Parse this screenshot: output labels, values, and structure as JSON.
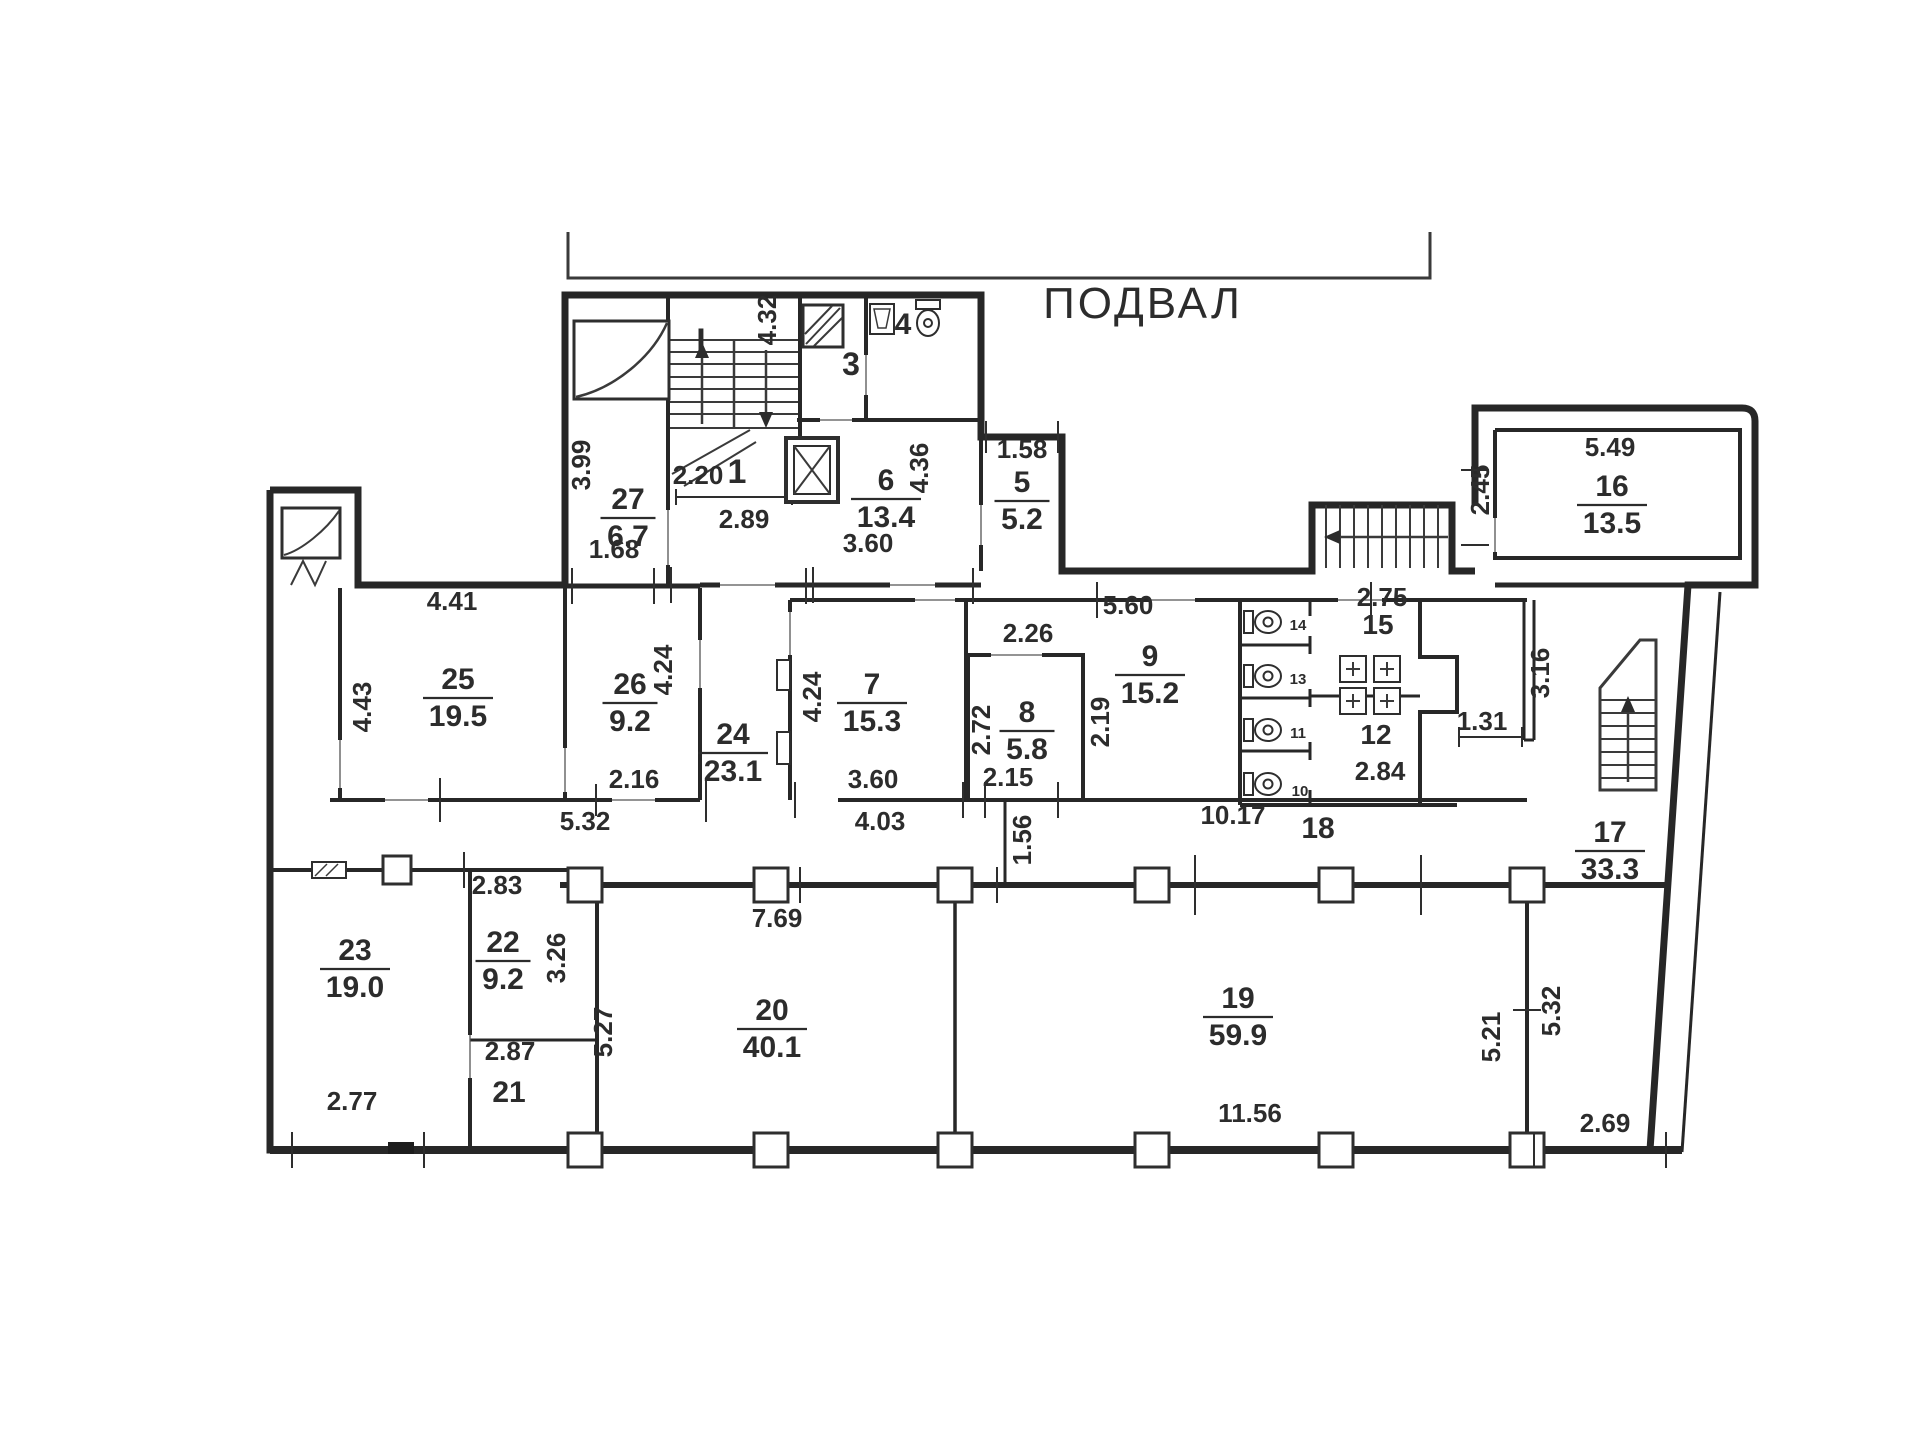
{
  "title": {
    "text": "ПОДВАЛ"
  },
  "marker": {
    "text": "I",
    "color": "#c0392b"
  },
  "colors": {
    "wall": "#272727",
    "text": "#2c2c2c",
    "background": "#ffffff"
  },
  "rooms": [
    {
      "no": "27",
      "area": "6.7",
      "x": 628,
      "y": 515
    },
    {
      "no": "1",
      "area": null,
      "x": 737,
      "y": 483,
      "size": 34
    },
    {
      "no": "3",
      "area": null,
      "x": 851,
      "y": 375,
      "size": 32
    },
    {
      "no": "4",
      "area": null,
      "x": 903,
      "y": 334,
      "size": 30
    },
    {
      "no": "6",
      "area": "13.4",
      "x": 886,
      "y": 496
    },
    {
      "no": "5",
      "area": "5.2",
      "x": 1022,
      "y": 498
    },
    {
      "no": "16",
      "area": "13.5",
      "x": 1612,
      "y": 502
    },
    {
      "no": "7",
      "area": "15.3",
      "x": 872,
      "y": 700
    },
    {
      "no": "8",
      "area": "5.8",
      "x": 1027,
      "y": 728
    },
    {
      "no": "9",
      "area": "15.2",
      "x": 1150,
      "y": 672
    },
    {
      "no": "15",
      "area": null,
      "x": 1378,
      "y": 634,
      "size": 28
    },
    {
      "no": "12",
      "area": null,
      "x": 1376,
      "y": 744,
      "size": 28
    },
    {
      "no": "24",
      "area": "23.1",
      "x": 733,
      "y": 750
    },
    {
      "no": "25",
      "area": "19.5",
      "x": 458,
      "y": 695
    },
    {
      "no": "26",
      "area": "9.2",
      "x": 630,
      "y": 700
    },
    {
      "no": "17",
      "area": "33.3",
      "x": 1610,
      "y": 848
    },
    {
      "no": "18",
      "area": null,
      "x": 1318,
      "y": 838,
      "size": 30
    },
    {
      "no": "23",
      "area": "19.0",
      "x": 355,
      "y": 966
    },
    {
      "no": "22",
      "area": "9.2",
      "x": 503,
      "y": 958
    },
    {
      "no": "21",
      "area": null,
      "x": 509,
      "y": 1102,
      "size": 30
    },
    {
      "no": "20",
      "area": "40.1",
      "x": 772,
      "y": 1026
    },
    {
      "no": "19",
      "area": "59.9",
      "x": 1238,
      "y": 1014
    }
  ],
  "stalls": [
    {
      "no": "14",
      "x": 1298,
      "y": 630
    },
    {
      "no": "13",
      "x": 1298,
      "y": 684
    },
    {
      "no": "11",
      "x": 1298,
      "y": 738
    },
    {
      "no": "10",
      "x": 1300,
      "y": 796
    }
  ],
  "dims": [
    {
      "t": "3.99",
      "x": 590,
      "y": 465,
      "rot": true
    },
    {
      "t": "2.20",
      "x": 698,
      "y": 484
    },
    {
      "t": "2.89",
      "x": 744,
      "y": 528
    },
    {
      "t": "4.32",
      "x": 776,
      "y": 320,
      "rot": true
    },
    {
      "t": "4.36",
      "x": 928,
      "y": 468,
      "rot": true
    },
    {
      "t": "1.58",
      "x": 1022,
      "y": 458
    },
    {
      "t": "3.60",
      "x": 868,
      "y": 552
    },
    {
      "t": "1.68",
      "x": 614,
      "y": 558
    },
    {
      "t": "4.41",
      "x": 452,
      "y": 610
    },
    {
      "t": "4.43",
      "x": 371,
      "y": 707,
      "rot": true
    },
    {
      "t": "4.24",
      "x": 672,
      "y": 670,
      "rot": true
    },
    {
      "t": "2.16",
      "x": 634,
      "y": 788
    },
    {
      "t": "5.32",
      "x": 585,
      "y": 830
    },
    {
      "t": "4.24",
      "x": 821,
      "y": 697,
      "rot": true
    },
    {
      "t": "3.60",
      "x": 873,
      "y": 788
    },
    {
      "t": "4.03",
      "x": 880,
      "y": 830
    },
    {
      "t": "2.26",
      "x": 1028,
      "y": 642
    },
    {
      "t": "2.72",
      "x": 990,
      "y": 730,
      "rot": true
    },
    {
      "t": "2.15",
      "x": 1008,
      "y": 786
    },
    {
      "t": "1.56",
      "x": 1031,
      "y": 840,
      "rot": true
    },
    {
      "t": "2.19",
      "x": 1109,
      "y": 722,
      "rot": true
    },
    {
      "t": "5.60",
      "x": 1128,
      "y": 614
    },
    {
      "t": "2.75",
      "x": 1382,
      "y": 606
    },
    {
      "t": "2.84",
      "x": 1380,
      "y": 780
    },
    {
      "t": "1.31",
      "x": 1482,
      "y": 730
    },
    {
      "t": "3.16",
      "x": 1549,
      "y": 673,
      "rot": true
    },
    {
      "t": "2.45",
      "x": 1489,
      "y": 490,
      "rot": true
    },
    {
      "t": "5.49",
      "x": 1610,
      "y": 456
    },
    {
      "t": "10.17",
      "x": 1233,
      "y": 824
    },
    {
      "t": "7.69",
      "x": 777,
      "y": 927
    },
    {
      "t": "5.27",
      "x": 612,
      "y": 1032,
      "rot": true
    },
    {
      "t": "3.26",
      "x": 565,
      "y": 958,
      "rot": true
    },
    {
      "t": "2.83",
      "x": 497,
      "y": 894
    },
    {
      "t": "2.87",
      "x": 510,
      "y": 1060
    },
    {
      "t": "2.77",
      "x": 352,
      "y": 1110
    },
    {
      "t": "11.56",
      "x": 1250,
      "y": 1122
    },
    {
      "t": "5.21",
      "x": 1500,
      "y": 1037,
      "rot": true
    },
    {
      "t": "5.32",
      "x": 1560,
      "y": 1011,
      "rot": true
    },
    {
      "t": "2.69",
      "x": 1605,
      "y": 1132
    }
  ]
}
